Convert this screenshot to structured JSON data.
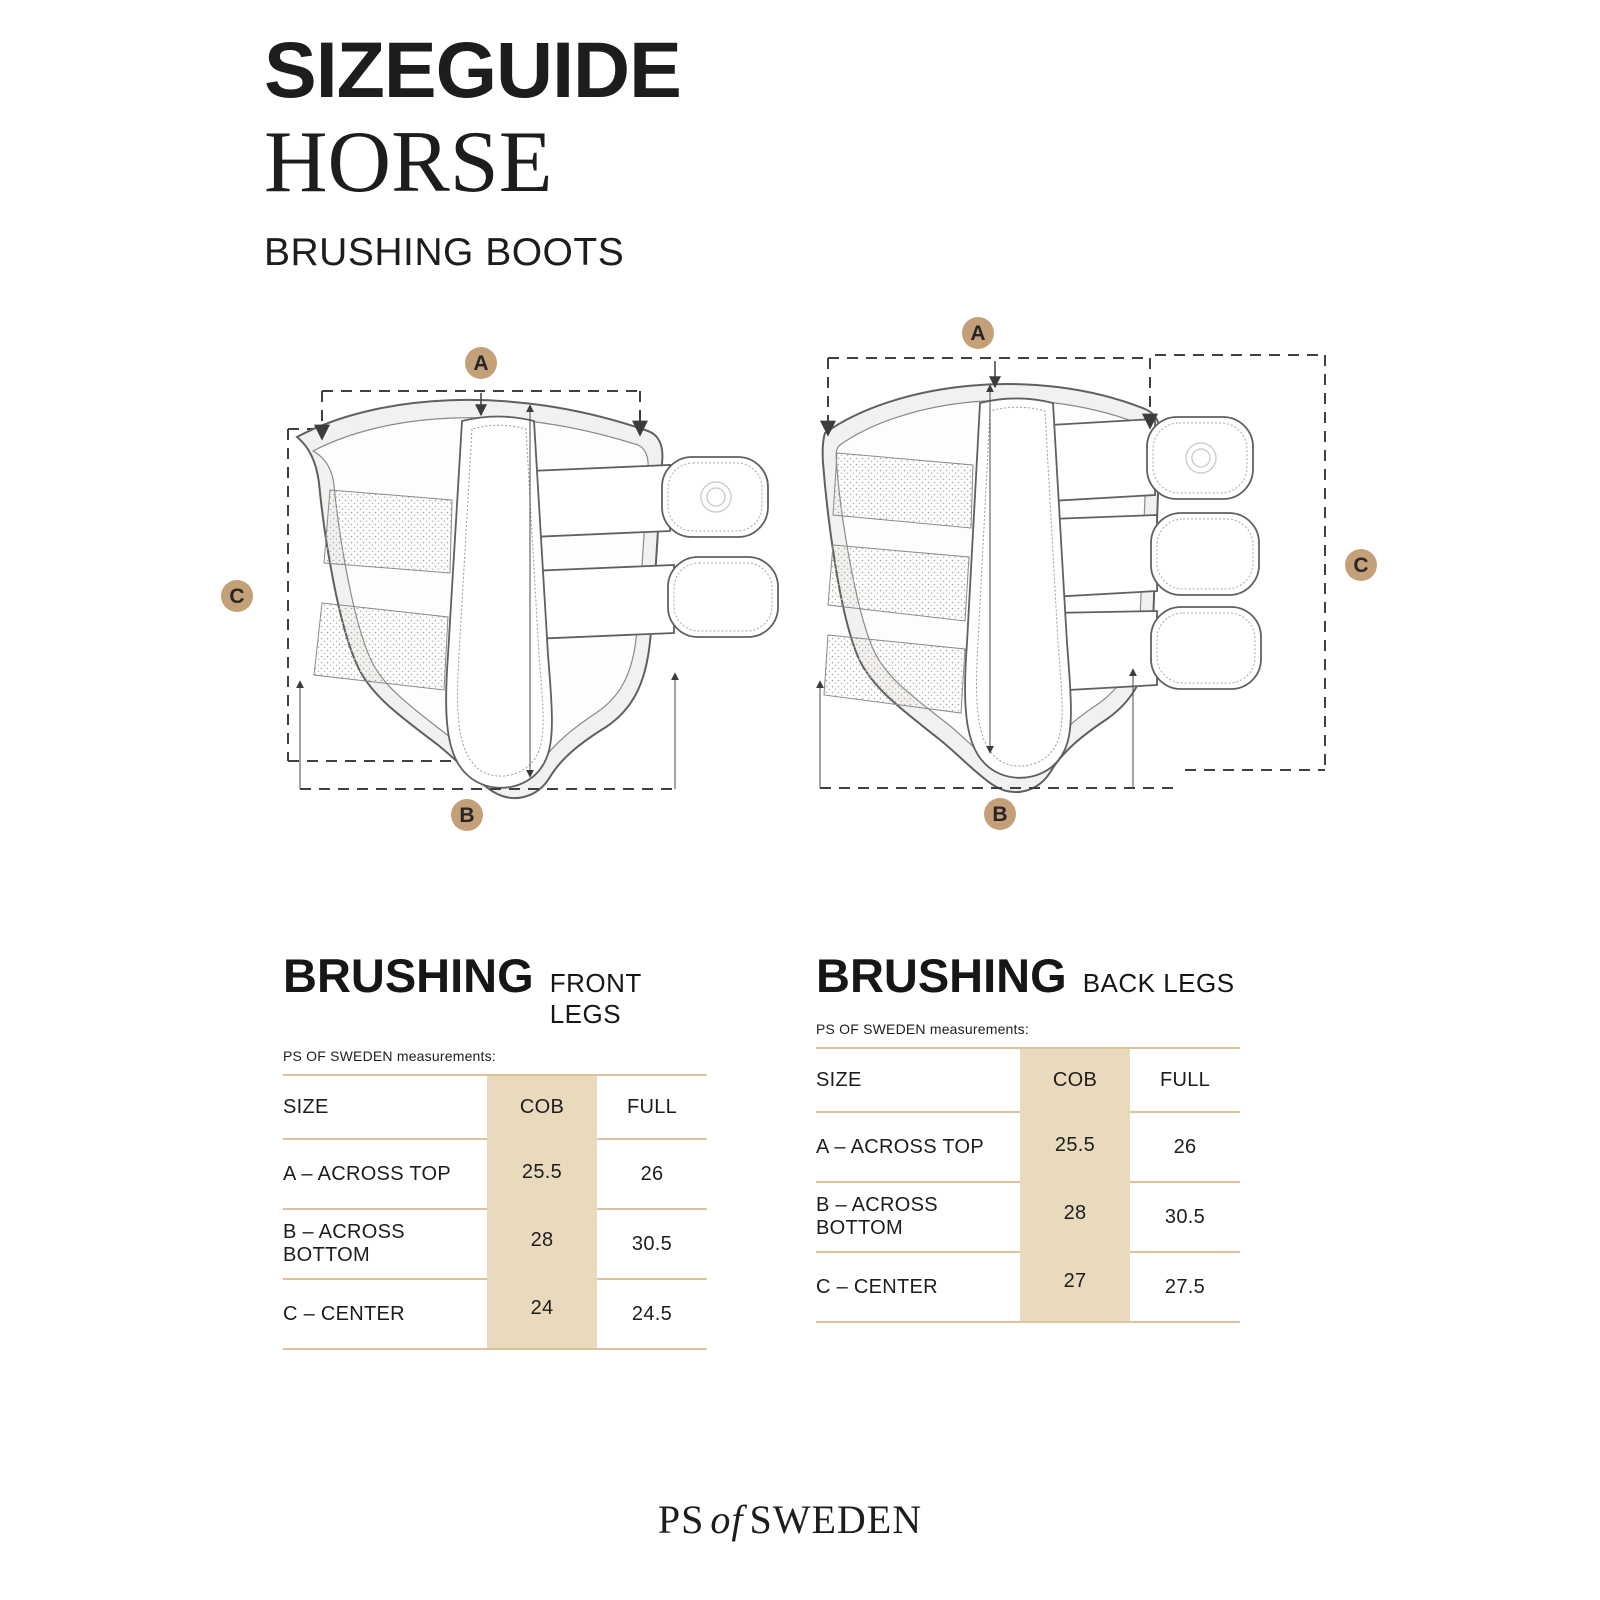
{
  "header": {
    "title_line1": "SIZEGUIDE",
    "title_line2": "HORSE",
    "subtitle": "BRUSHING BOOTS"
  },
  "diagrams": {
    "front": {
      "marker_a": "A",
      "marker_b": "B",
      "marker_c": "C"
    },
    "back": {
      "marker_a": "A",
      "marker_b": "B",
      "marker_c": "C"
    }
  },
  "tables": [
    {
      "title": "BRUSHING",
      "legs": "FRONT LEGS",
      "note": "PS OF SWEDEN measurements:",
      "col_size": "SIZE",
      "col_cob": "COB",
      "col_full": "FULL",
      "rows": [
        {
          "label": "A – ACROSS TOP",
          "cob": "25.5",
          "full": "26"
        },
        {
          "label": "B – ACROSS BOTTOM",
          "cob": "28",
          "full": "30.5"
        },
        {
          "label": "C – CENTER",
          "cob": "24",
          "full": "24.5"
        }
      ]
    },
    {
      "title": "BRUSHING",
      "legs": "BACK LEGS",
      "note": "PS OF SWEDEN measurements:",
      "col_size": "SIZE",
      "col_cob": "COB",
      "col_full": "FULL",
      "rows": [
        {
          "label": "A – ACROSS TOP",
          "cob": "25.5",
          "full": "26"
        },
        {
          "label": "B – ACROSS BOTTOM",
          "cob": "28",
          "full": "30.5"
        },
        {
          "label": "C – CENTER",
          "cob": "27",
          "full": "27.5"
        }
      ]
    }
  ],
  "footer": {
    "brand_prefix": "PS",
    "brand_mid": "of",
    "brand_suffix": "SWEDEN"
  },
  "colors": {
    "accent_tan": "#c3a077",
    "table_band": "#e9dabd",
    "table_line": "#dbc49c",
    "ink": "#1d1d1b",
    "drawing_line": "#606060"
  }
}
